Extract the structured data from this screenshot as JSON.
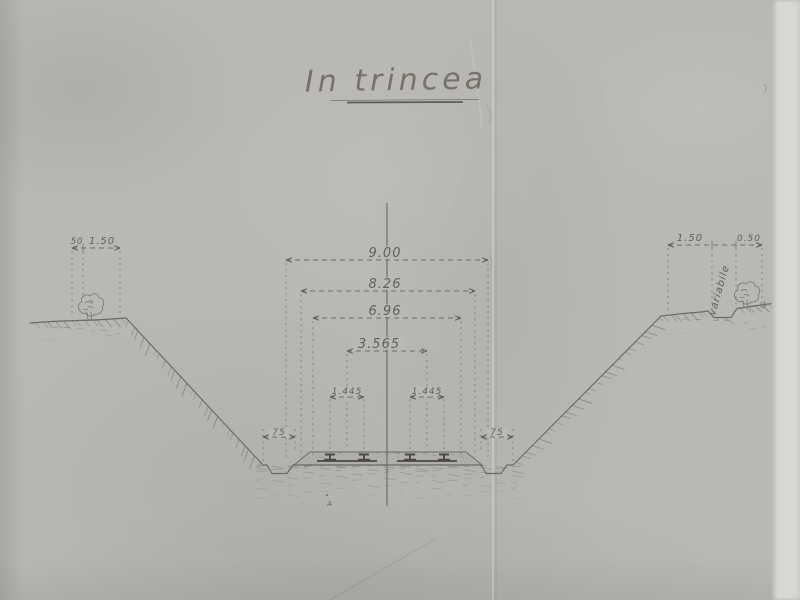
{
  "title": {
    "text": "In trincea"
  },
  "dims": {
    "w900": "9.00",
    "w826": "8.26",
    "w696": "6.96",
    "w3565": "3.565",
    "gaugeLeft": "1.445",
    "gaugeRight": "1.445",
    "shoulderLeft": "75",
    "shoulderRight": "75"
  },
  "leftBerm": {
    "w050": "50",
    "w150": "1.50"
  },
  "rightBerm": {
    "w150": "1.50",
    "variable": "variabile",
    "w050": "0.50"
  },
  "groundMark": {
    "text": "A"
  },
  "colors": {
    "paper": "#b9b8b4",
    "edgeStrip": "#d9d7d3",
    "ink": "#6e6c66",
    "inkDark": "#4b4945"
  }
}
